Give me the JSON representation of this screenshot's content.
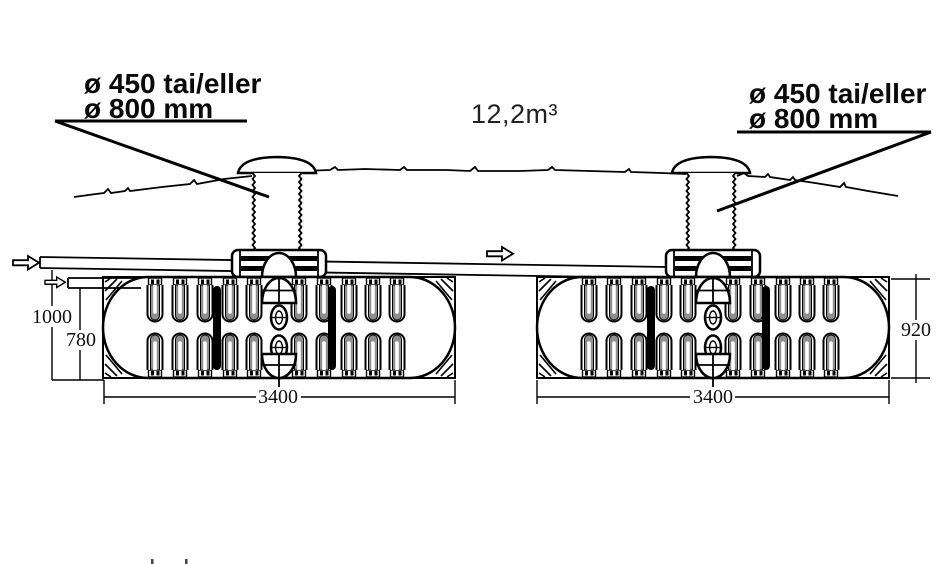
{
  "figure": {
    "volume_label": "12,2m³",
    "callout_left": {
      "line1": "ø 450 tai/eller",
      "line2": "ø 800 mm"
    },
    "callout_right": {
      "line1": "ø 450 tai/eller",
      "line2": "ø 800 mm"
    },
    "dimensions": {
      "total_depth": "1000",
      "inlet_depth": "780",
      "tank_height": "920",
      "tank_length_left": "3400",
      "tank_length_right": "3400"
    },
    "icons": [
      "flow-arrow-icon"
    ],
    "colors": {
      "ink": "#000000",
      "rib_gray": "#8f8f8f",
      "background": "#ffffff"
    }
  }
}
